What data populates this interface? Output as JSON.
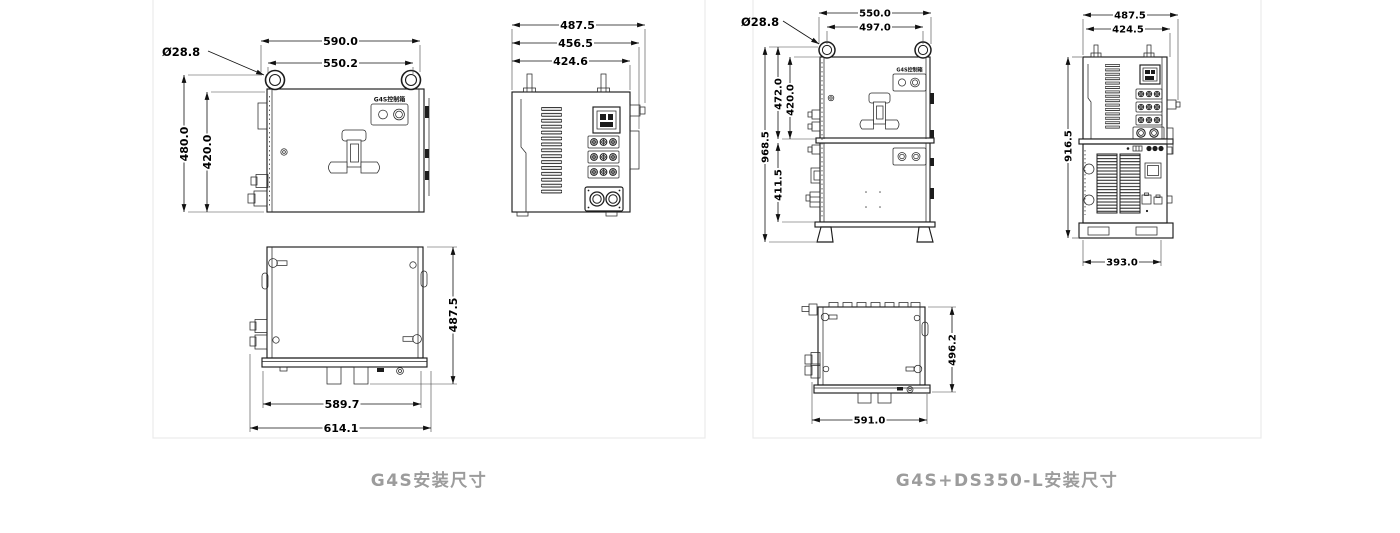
{
  "cards": {
    "g4s": {
      "caption": "G4S安装尺寸"
    },
    "combo": {
      "caption": "G4S+DS350-L安装尺寸"
    }
  },
  "device_badge": "G4S控制箱",
  "dims": {
    "g4s": {
      "front_width_outer": "590.0",
      "front_width_inner": "550.2",
      "eye_diameter": "Ø28.8",
      "front_height_outer": "480.0",
      "front_height_inner": "420.0",
      "side_depth_outer": "487.5",
      "side_depth_mid": "456.5",
      "side_depth_inner": "424.6",
      "top_depth": "487.5",
      "top_width_inner": "589.7",
      "top_width_outer": "614.1"
    },
    "combo": {
      "front_width_outer": "550.0",
      "front_width_inner": "497.0",
      "eye_diameter": "Ø28.8",
      "height_total": "968.5",
      "upper_height_outer": "472.0",
      "upper_height_inner": "420.0",
      "lower_height": "411.5",
      "side_depth_outer": "487.5",
      "side_depth_inner": "424.5",
      "side_height": "916.5",
      "side_base_width": "393.0",
      "top_width": "591.0",
      "top_depth": "496.2"
    }
  }
}
